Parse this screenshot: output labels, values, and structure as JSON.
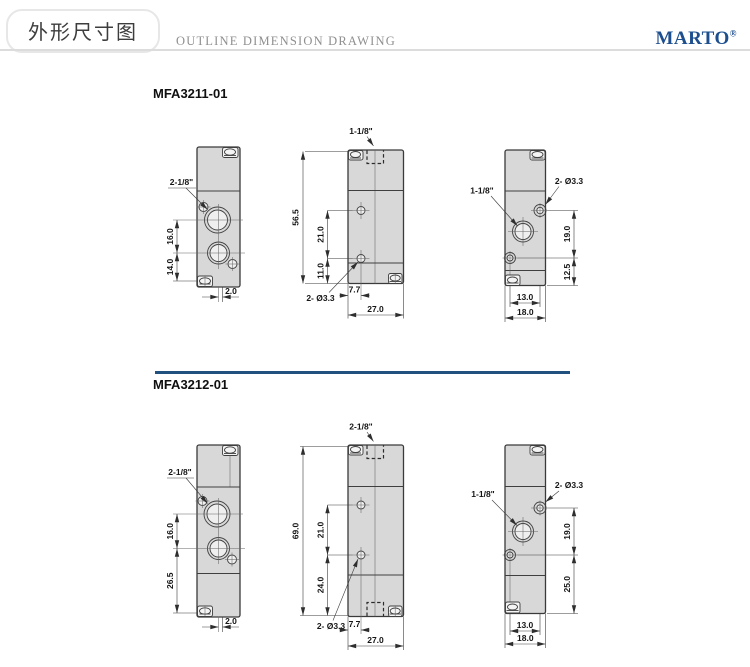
{
  "header": {
    "title_cn": "外形尺寸图",
    "title_en": "OUTLINE DIMENSION DRAWING",
    "brand": "MARTO",
    "brand_mark": "®"
  },
  "colors": {
    "brand_blue": "#1d4f8f",
    "divider_blue": "#20517f",
    "drawing_body_fill": "#d8d8d8",
    "drawing_line": "#3a3a3a"
  },
  "sections": [
    {
      "model": "MFA3211-01",
      "side_view": {
        "port_label": "2-1/8\"",
        "dim_a": "16.0",
        "dim_b": "14.0",
        "dim_offset": "2.0"
      },
      "front_view": {
        "port_label": "1-1/8\"",
        "dim_height": "56.5",
        "dim_a": "21.0",
        "dim_b": "11.0",
        "hole_label": "2- Ø3.3",
        "dim_x1": "7.7",
        "dim_width": "27.0"
      },
      "end_view": {
        "port_label": "1-1/8\"",
        "hole_label": "2- Ø3.3",
        "dim_a": "19.0",
        "dim_b": "12.5",
        "dim_x1": "13.0",
        "dim_width": "18.0"
      }
    },
    {
      "model": "MFA3212-01",
      "side_view": {
        "port_label": "2-1/8\"",
        "dim_a": "16.0",
        "dim_b": "26.5",
        "dim_offset": "2.0"
      },
      "front_view": {
        "port_label": "2-1/8\"",
        "dim_height": "69.0",
        "dim_a": "21.0",
        "dim_b": "24.0",
        "hole_label": "2- Ø3.3",
        "dim_x1": "7.7",
        "dim_width": "27.0"
      },
      "end_view": {
        "port_label": "1-1/8\"",
        "hole_label": "2- Ø3.3",
        "dim_a": "19.0",
        "dim_b": "25.0",
        "dim_x1": "13.0",
        "dim_width": "18.0"
      }
    }
  ]
}
